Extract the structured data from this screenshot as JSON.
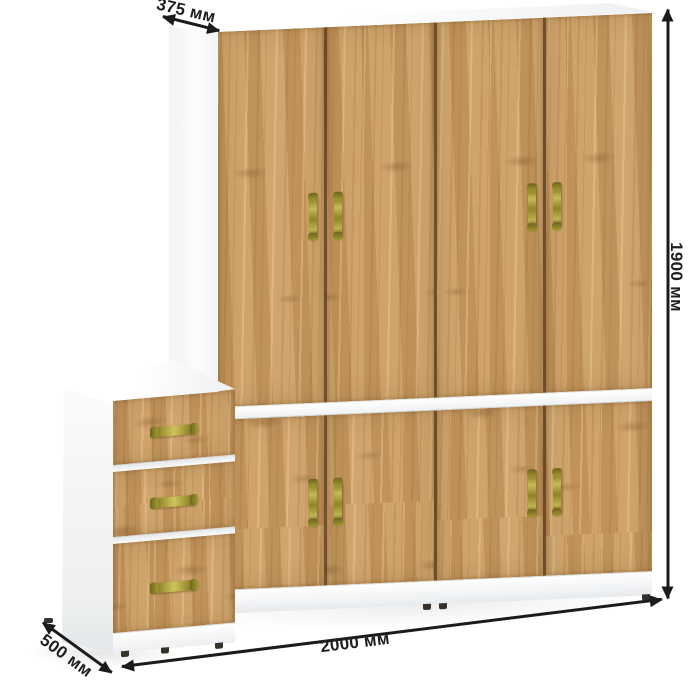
{
  "dimensions": {
    "top_depth": {
      "label": "375 мм"
    },
    "height": {
      "label": "1900 мм"
    },
    "width": {
      "label": "2000 мм"
    },
    "side_depth": {
      "label": "500 мм"
    }
  },
  "structure": {
    "upper_doors": 4,
    "lower_doors": 4,
    "drawers": 3,
    "door_handles": 8,
    "drawer_handles": 3
  },
  "colors": {
    "wood": "#c99c63",
    "wood_dark_streak": "#a5793f",
    "wood_light_streak": "#ddb887",
    "carcass_white": "#ffffff",
    "handle_brass": "#958b2f",
    "door_gap": "#74552f",
    "dimension_line": "#1b1b1b",
    "dimension_text": "#1f1f1f",
    "background": "#ffffff"
  }
}
